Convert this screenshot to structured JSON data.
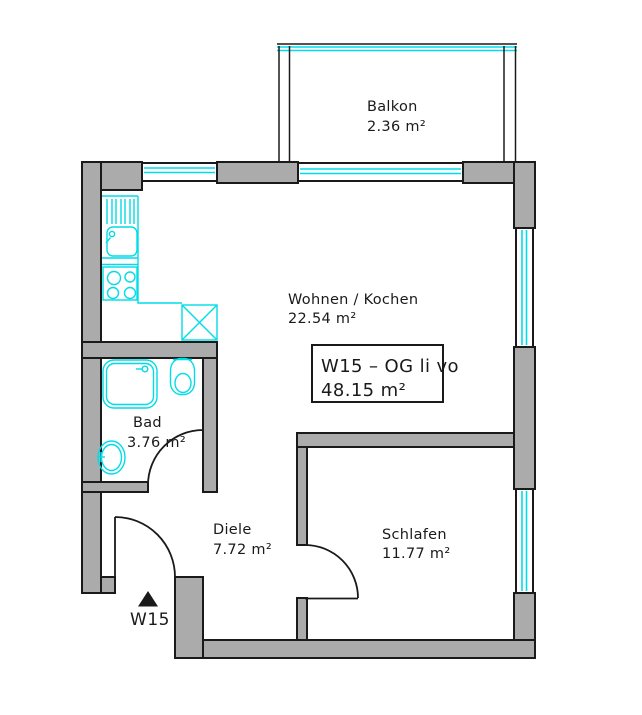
{
  "plan": {
    "rooms": {
      "balkon": {
        "name": "Balkon",
        "area": "2.36 m²"
      },
      "wohnen": {
        "name": "Wohnen / Kochen",
        "area": "22.54 m²"
      },
      "bad": {
        "name": "Bad",
        "area": "3.76 m²"
      },
      "diele": {
        "name": "Diele",
        "area": "7.72 m²"
      },
      "schlafen": {
        "name": "Schlafen",
        "area": "11.77 m²"
      }
    },
    "info_box": {
      "title": "W15 – OG li vo",
      "area": "48.15 m²"
    },
    "entrance": {
      "label": "W15"
    },
    "colors": {
      "wall": "#ababab",
      "fixtures": "#00dce8",
      "outline": "#1a1a1a"
    }
  }
}
